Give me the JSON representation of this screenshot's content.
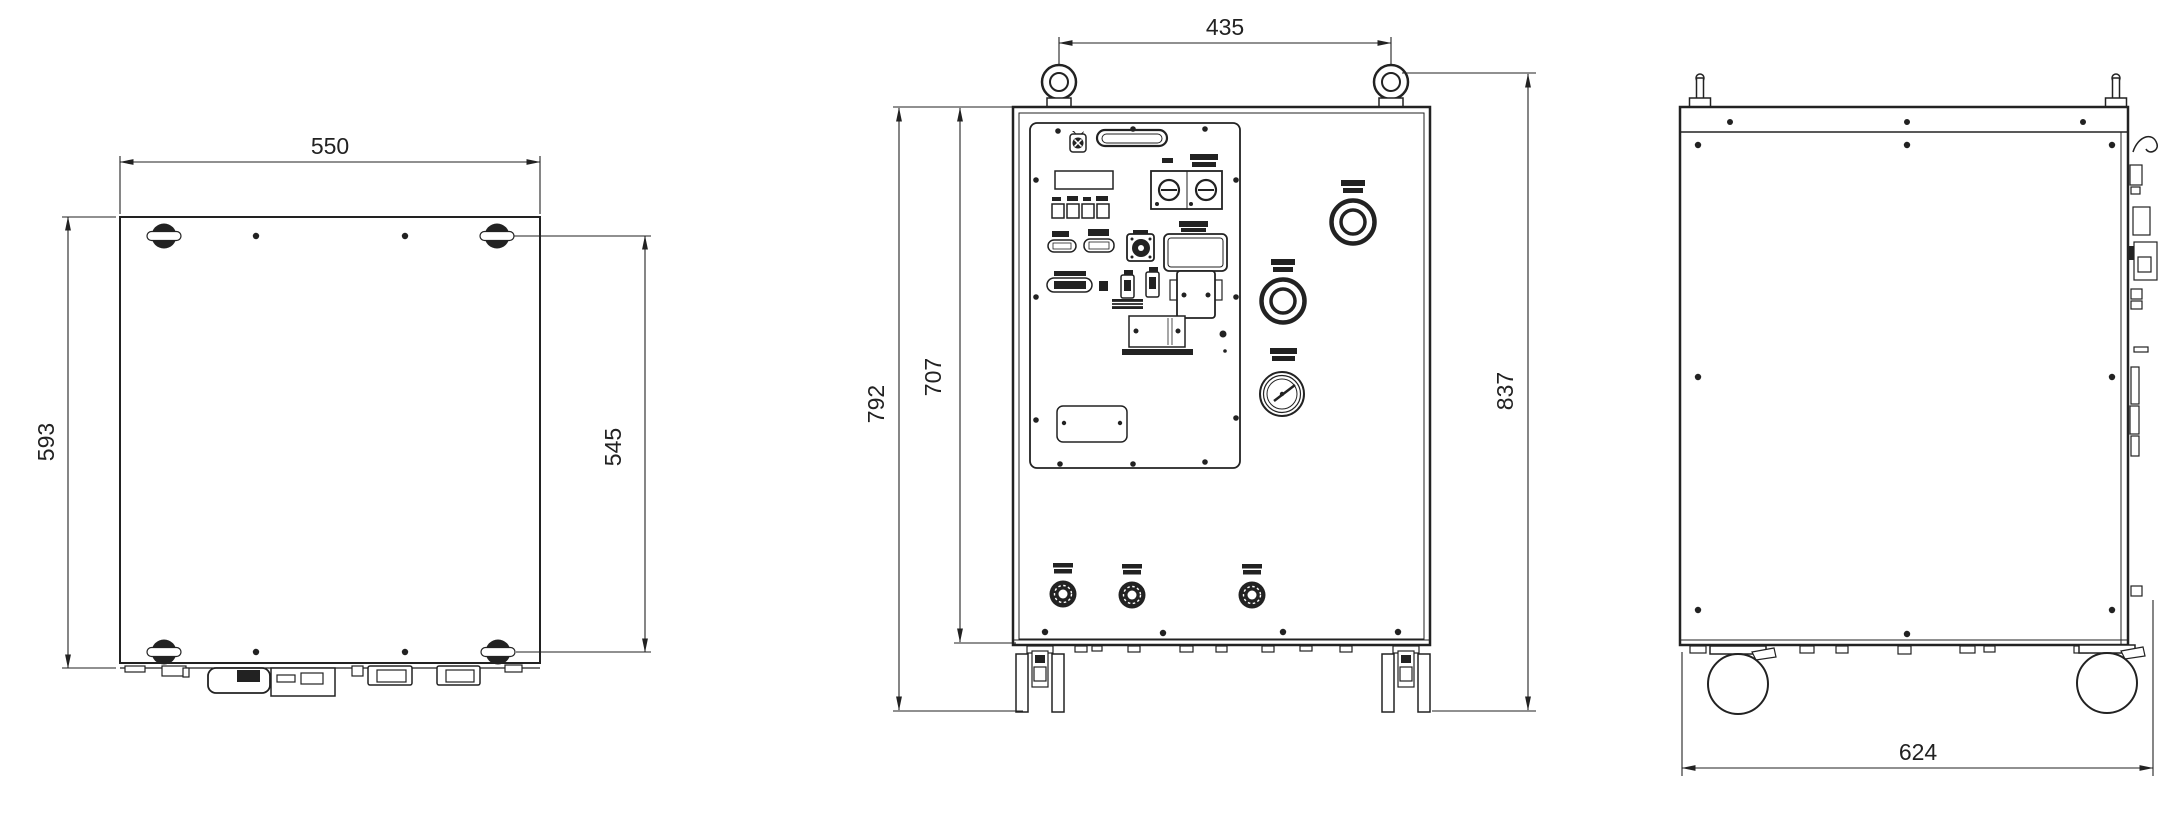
{
  "drawing": {
    "kind": "three-view dimensioned outline drawing of a wheeled equipment cabinet",
    "views": {
      "top": {
        "dims": {
          "width": "550",
          "depth": "593",
          "eyebolt_pitch_depth": "545"
        }
      },
      "front": {
        "dims": {
          "eyebolt_pitch_width": "435",
          "height_with_casters": "792",
          "body_height": "707",
          "overall_height": "837"
        }
      },
      "side": {
        "dims": {
          "overall_depth": "624"
        }
      }
    },
    "line_color": "#222222",
    "background": "#ffffff"
  }
}
